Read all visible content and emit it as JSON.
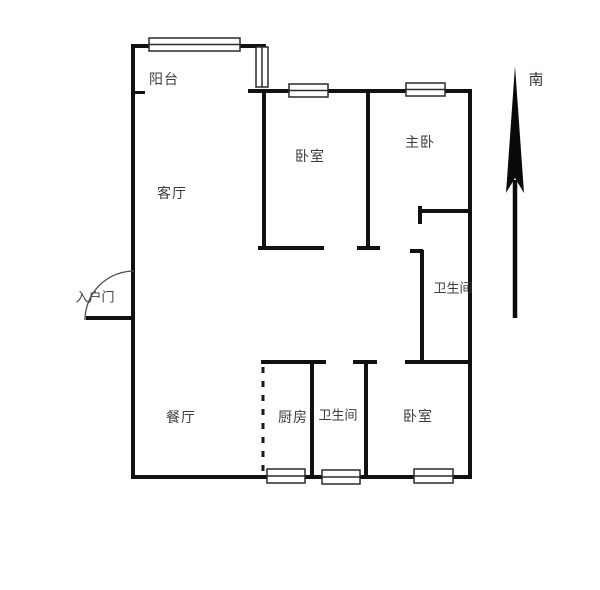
{
  "rooms": {
    "balcony": "阳台",
    "living": "客厅",
    "bedroom_top": "卧室",
    "master": "主卧",
    "bath_upper": "卫生间",
    "entrance": "入户门",
    "dining": "餐厅",
    "kitchen": "厨房",
    "bath_lower": "卫生间",
    "bedroom_lower": "卧室"
  },
  "compass": {
    "label": "南"
  },
  "colors": {
    "wall": "#111111",
    "window_border": "#2a2a2a",
    "window_fill": "#ffffff",
    "door_arc": "#4a4a4a",
    "dashed_line": "#1a1a1a",
    "arrow": "#0a0a0a",
    "text": "#3c3c3c"
  },
  "floorplan": {
    "canvas": {
      "width": 600,
      "height": 590
    },
    "walls": [
      {
        "name": "balcony-top-wall",
        "x": 131,
        "y": 44,
        "w": 135,
        "h": 4
      },
      {
        "name": "left-outer-wall",
        "x": 131,
        "y": 44,
        "w": 4,
        "h": 435
      },
      {
        "name": "balcony-divider-tick",
        "x": 131,
        "y": 91,
        "w": 14,
        "h": 3
      },
      {
        "name": "north-outer-wall",
        "x": 248,
        "y": 89,
        "w": 224,
        "h": 4
      },
      {
        "name": "right-outer-wall",
        "x": 468,
        "y": 89,
        "w": 4,
        "h": 390
      },
      {
        "name": "bottom-outer-wall",
        "x": 131,
        "y": 475,
        "w": 341,
        "h": 4
      },
      {
        "name": "living-bedroom-divider",
        "x": 262,
        "y": 91,
        "w": 4,
        "h": 159
      },
      {
        "name": "bedroom-top-south-wall",
        "x": 258,
        "y": 246,
        "w": 66,
        "h": 4
      },
      {
        "name": "bedroom-master-divider",
        "x": 366,
        "y": 91,
        "w": 4,
        "h": 156
      },
      {
        "name": "divider-end-cap",
        "x": 357,
        "y": 246,
        "w": 23,
        "h": 4
      },
      {
        "name": "master-south-wall",
        "x": 419,
        "y": 209,
        "w": 53,
        "h": 4
      },
      {
        "name": "master-south-end-cap",
        "x": 418,
        "y": 206,
        "w": 4,
        "h": 18
      },
      {
        "name": "bath-upper-left-wall",
        "x": 420,
        "y": 250,
        "w": 4,
        "h": 113
      },
      {
        "name": "bath-upper-top-cap",
        "x": 410,
        "y": 249,
        "w": 13,
        "h": 4
      },
      {
        "name": "bath-upper-bottom-wall",
        "x": 405,
        "y": 360,
        "w": 67,
        "h": 4
      },
      {
        "name": "kitchen-north-wall",
        "x": 261,
        "y": 360,
        "w": 65,
        "h": 4
      },
      {
        "name": "lower-divider-top-cap",
        "x": 353,
        "y": 360,
        "w": 24,
        "h": 4
      },
      {
        "name": "bath-bedroom-divider",
        "x": 364,
        "y": 360,
        "w": 4,
        "h": 119
      },
      {
        "name": "kitchen-bath-divider",
        "x": 310,
        "y": 360,
        "w": 4,
        "h": 119
      }
    ],
    "windows": [
      {
        "name": "balcony-window",
        "x": 149,
        "y": 38,
        "w": 91,
        "h": 13,
        "o": "h"
      },
      {
        "name": "balcony-side-window",
        "x": 256,
        "y": 47,
        "w": 12,
        "h": 40,
        "o": "v"
      },
      {
        "name": "bedroom-top-window",
        "x": 289,
        "y": 84,
        "w": 39,
        "h": 13,
        "o": "h"
      },
      {
        "name": "master-window",
        "x": 406,
        "y": 83,
        "w": 39,
        "h": 13,
        "o": "h"
      },
      {
        "name": "kitchen-window",
        "x": 267,
        "y": 469,
        "w": 38,
        "h": 14,
        "o": "h"
      },
      {
        "name": "bath-lower-window",
        "x": 322,
        "y": 470,
        "w": 38,
        "h": 14,
        "o": "h"
      },
      {
        "name": "bedroom-lower-window",
        "x": 414,
        "y": 469,
        "w": 39,
        "h": 14,
        "o": "h"
      }
    ],
    "dashed_lines": [
      {
        "name": "kitchen-open-boundary",
        "x1": 263,
        "y1": 367,
        "x2": 263,
        "y2": 473
      }
    ],
    "door": {
      "arc_path": "M 134 271 A 49 49 0 0 0 85 320",
      "leaf": {
        "x": 86,
        "y": 316,
        "w": 48,
        "h": 4
      }
    },
    "compass_arrow": {
      "head_points": "515,66 524,193 515,178 506,193",
      "shaft": {
        "x1": 515,
        "y1": 180,
        "x2": 515,
        "y2": 318,
        "w": 4.5
      }
    }
  }
}
